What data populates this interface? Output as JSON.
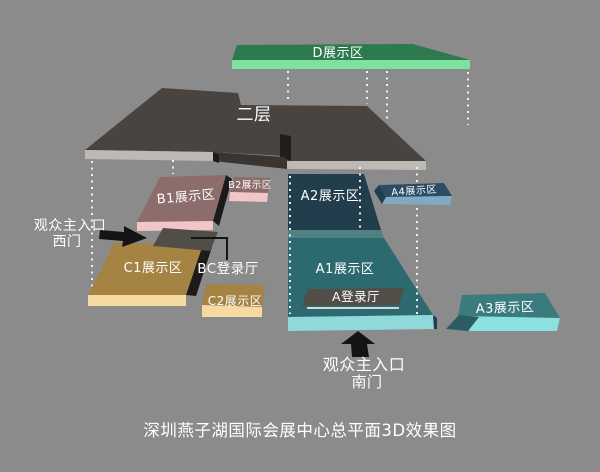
{
  "title": "深圳燕子湖国际会展中心总平面3D效果图",
  "areas": {
    "d": "D展示区",
    "second_floor": "二层",
    "b1": "B1展示区",
    "b2": "B2展示区",
    "a1": "A1展示区",
    "a2": "A2展示区",
    "a3": "A3展示区",
    "a4": "A4展示区",
    "c1": "C1展示区",
    "c2": "C2展示区",
    "a_hall": "A登录厅",
    "bc_hall": "BC登录厅"
  },
  "entrances": {
    "west": {
      "line1": "观众主入口",
      "line2": "西门"
    },
    "south": {
      "line1": "观众主入口",
      "line2": "南门"
    }
  },
  "colors": {
    "background": "#8b8b8b",
    "d_top": "#2d7a4e",
    "d_front": "#7de2a0",
    "floor_top": "#49443f",
    "floor_edge": "#bdbab6",
    "floor_shadow": "#211e1c",
    "floor_mid": "#3a3531",
    "b_top": "#8d6c6c",
    "b_front": "#f2c6c9",
    "a2_top": "#223e4d",
    "a1_top": "#2d6a70",
    "a_step": "#4e8280",
    "a_front": "#8fd9da",
    "a4_top": "#2b4c64",
    "a4_front": "#80aac3",
    "a4_side": "#1f3e52",
    "a3_top": "#3a7b7e",
    "a3_front": "#8ce0e0",
    "a3_side": "#2b5c62",
    "c_top": "#a48343",
    "c_front": "#f6daa1",
    "hall_gray": "#514d47",
    "hall_underline": "#d6d6d6",
    "shadow_black": "#1d1b19",
    "arrow_black": "#141414",
    "column_dots": "#f2f2f2",
    "caption_text": "#4a4a4a",
    "label_text": "#ffffff"
  }
}
